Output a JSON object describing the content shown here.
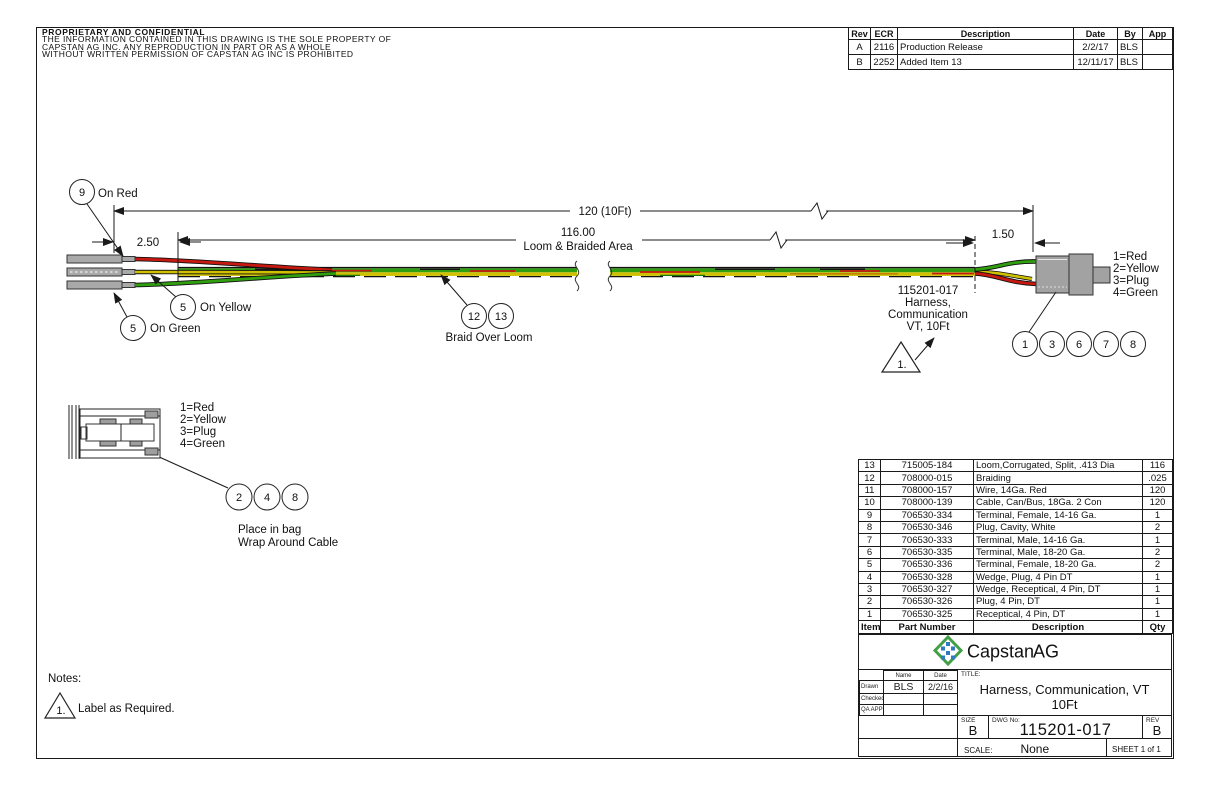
{
  "proprietary": {
    "title": "PROPRIETARY AND CONFIDENTIAL",
    "lines": [
      "THE INFORMATION CONTAINED IN THIS DRAWING IS THE SOLE PROPERTY OF",
      "CAPSTAN AG INC. ANY REPRODUCTION IN PART OR AS A WHOLE",
      "WITHOUT WRITTEN PERMISSION OF CAPSTAN AG INC IS PROHIBITED"
    ]
  },
  "revision_table": {
    "headers": [
      "Rev",
      "ECR",
      "Description",
      "Date",
      "By",
      "App"
    ],
    "rows": [
      [
        "A",
        "2116",
        "Production Release",
        "2/2/17",
        "BLS",
        ""
      ],
      [
        "B",
        "2252",
        "Added Item 13",
        "12/11/17",
        "BLS",
        ""
      ]
    ]
  },
  "drawing": {
    "dimensions": {
      "overall": "120 (10Ft)",
      "loom_len": "116.00",
      "loom_label": "Loom & Braided Area",
      "left_stub": "2.50",
      "right_stub": "1.50"
    },
    "callouts": {
      "on_red": "On Red",
      "on_yellow": "On Yellow",
      "on_green": "On Green",
      "braid": "Braid Over Loom",
      "part_line1": "115201-017",
      "part_line2": "Harness,",
      "part_line3": "Communication",
      "part_line4": "VT, 10Ft",
      "flag": "1.",
      "bag_line1": "Place in bag",
      "bag_line2": "Wrap Around Cable"
    },
    "pin_labels": [
      "1=Red",
      "2=Yellow",
      "3=Plug",
      "4=Green"
    ],
    "balloons": {
      "left_red": "9",
      "left_yellow": "5",
      "left_green": "5",
      "braid_a": "12",
      "braid_b": "13",
      "conn_1": "1",
      "conn_3": "3",
      "conn_6": "6",
      "conn_7": "7",
      "conn_8": "8",
      "det_2": "2",
      "det_4": "4",
      "det_8": "8"
    }
  },
  "notes": {
    "title": "Notes:",
    "flag": "1.",
    "note1": "Label as Required."
  },
  "bom": {
    "headers": [
      "Item",
      "Part Number",
      "Description",
      "Qty"
    ],
    "rows": [
      [
        "13",
        "715005-184",
        "Loom,Corrugated, Split, .413 Dia",
        "116"
      ],
      [
        "12",
        "708000-015",
        "Braiding",
        ".025"
      ],
      [
        "11",
        "708000-157",
        "Wire, 14Ga. Red",
        "120"
      ],
      [
        "10",
        "708000-139",
        "Cable, Can/Bus, 18Ga. 2 Con",
        "120"
      ],
      [
        "9",
        "706530-334",
        "Terminal, Female, 14-16 Ga.",
        "1"
      ],
      [
        "8",
        "706530-346",
        "Plug, Cavity, White",
        "2"
      ],
      [
        "7",
        "706530-333",
        "Terminal, Male, 14-16 Ga.",
        "1"
      ],
      [
        "6",
        "706530-335",
        "Terminal, Male, 18-20 Ga.",
        "2"
      ],
      [
        "5",
        "706530-336",
        "Terminal, Female, 18-20 Ga.",
        "2"
      ],
      [
        "4",
        "706530-328",
        "Wedge, Plug, 4 Pin DT",
        "1"
      ],
      [
        "3",
        "706530-327",
        "Wedge, Receptical, 4 Pin, DT",
        "1"
      ],
      [
        "2",
        "706530-326",
        "Plug, 4 Pin, DT",
        "1"
      ],
      [
        "1",
        "706530-325",
        "Receptical, 4 Pin, DT",
        "1"
      ]
    ]
  },
  "title_block": {
    "logo": {
      "brand": "Capstan",
      "suffix": "AG"
    },
    "approvals": {
      "name_header": "Name",
      "date_header": "Date",
      "rows": [
        {
          "label": "Drawn",
          "name": "BLS",
          "date": "2/2/16"
        },
        {
          "label": "Checked",
          "name": "",
          "date": ""
        },
        {
          "label": "QA APP",
          "name": "",
          "date": ""
        }
      ]
    },
    "title_label": "TITLE:",
    "title_line1": "Harness, Communication, VT",
    "title_line2": "10Ft",
    "size_label": "SIZE",
    "size": "B",
    "dwg_label": "DWG No:",
    "dwg_no": "115201-017",
    "rev_label": "REV",
    "rev": "B",
    "scale_label": "SCALE:",
    "scale": "None",
    "sheet": "SHEET 1 of 1"
  },
  "colors": {
    "wire_red": "#c81910",
    "wire_green": "#2f9e0f",
    "wire_yellow": "#cfc000",
    "metal_gray": "#a9a9a9",
    "connector_gray": "#a2a2a2",
    "logo_green": "#43a047",
    "logo_blue": "#2e7bc0",
    "logo_text": "#8e959b",
    "logo_text_light": "#b9c0c5"
  }
}
